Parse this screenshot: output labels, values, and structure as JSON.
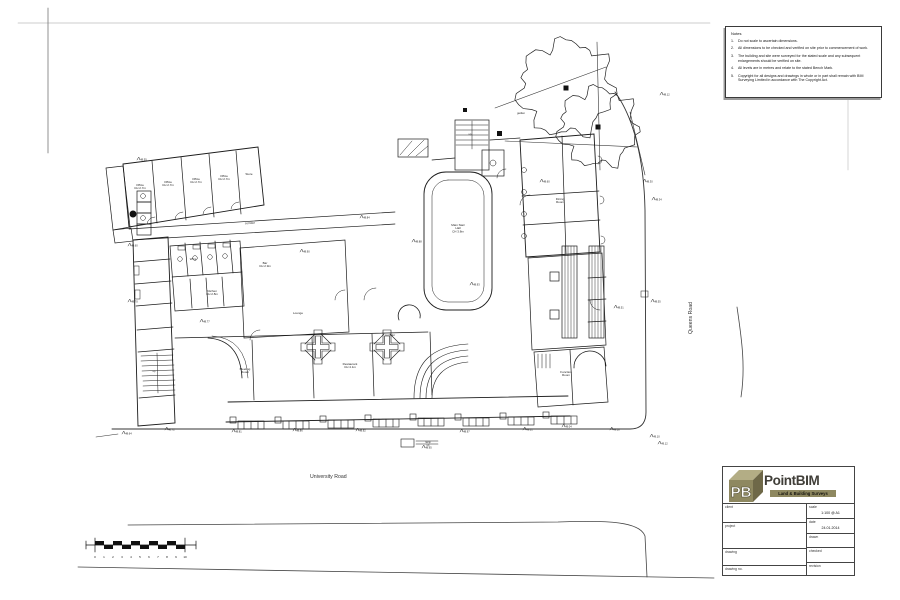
{
  "sheet": {
    "notes": {
      "title": "Notes",
      "items": [
        {
          "n": "1.",
          "text": "Do not scale to ascertain dimensions."
        },
        {
          "n": "2.",
          "text": "All dimensions to be checked and verified on site prior to commencement of work."
        },
        {
          "n": "3.",
          "text": "The building and site were surveyed for the stated scale and any subsequent enlargements should be verified on site."
        },
        {
          "n": "4.",
          "text": "All levels are in metres and relate to the stated Bench Mark."
        },
        {
          "n": "5.",
          "text": "Copyright for all designs and drawings in whole or in part shall remain with BIM Surveying Limited in accordance with The Copyright Act."
        }
      ]
    },
    "roads": {
      "university": "University Road",
      "queens": "Queens Road"
    },
    "scalebar": {
      "numbers": [
        "0",
        "1",
        "2",
        "3",
        "4",
        "5",
        "6",
        "7",
        "8",
        "9",
        "10"
      ]
    },
    "titleblock": {
      "brand": "PointBIM",
      "tagline": "Land & Building Surveys",
      "logo_letters": "PB",
      "fields": [
        {
          "label": "client",
          "value": ""
        },
        {
          "label": "project",
          "value": ""
        },
        {
          "label": "drawing",
          "value": ""
        },
        {
          "label": "drawing no.",
          "value": ""
        },
        {
          "label": "scale",
          "value": "1:100 @ A1"
        },
        {
          "label": "date",
          "value": "24.01.2014"
        },
        {
          "label": "drawn",
          "value": ""
        },
        {
          "label": "checked",
          "value": ""
        },
        {
          "label": "revision",
          "value": ""
        }
      ]
    },
    "colors": {
      "accent_olive": "#8e8860",
      "line": "#1c1c1c"
    }
  },
  "plan": {
    "room_labels": [
      {
        "x": 140,
        "y": 186,
        "lines": [
          "Office",
          "CH 2.7m"
        ]
      },
      {
        "x": 168,
        "y": 183,
        "lines": [
          "Office",
          "CH 2.7m"
        ]
      },
      {
        "x": 196,
        "y": 180,
        "lines": [
          "Office",
          "CH 2.7m"
        ]
      },
      {
        "x": 224,
        "y": 177,
        "lines": [
          "Office",
          "CH 2.7m"
        ]
      },
      {
        "x": 249,
        "y": 175,
        "lines": [
          "Store"
        ]
      },
      {
        "x": 193,
        "y": 260,
        "lines": [
          "WCs"
        ]
      },
      {
        "x": 212,
        "y": 292,
        "lines": [
          "Kitchen",
          "CH 2.8m"
        ]
      },
      {
        "x": 265,
        "y": 264,
        "lines": [
          "Bar",
          "CH 2.9m"
        ]
      },
      {
        "x": 298,
        "y": 314,
        "lines": [
          "Lounge"
        ]
      },
      {
        "x": 458,
        "y": 226,
        "lines": [
          "Main Stair",
          "Hall",
          "CH 3.8m"
        ]
      },
      {
        "x": 560,
        "y": 200,
        "lines": [
          "Dining",
          "Room"
        ]
      },
      {
        "x": 566,
        "y": 373,
        "lines": [
          "Function",
          "Room"
        ]
      },
      {
        "x": 245,
        "y": 370,
        "lines": [
          "Meeting",
          "Room"
        ]
      },
      {
        "x": 350,
        "y": 365,
        "lines": [
          "Restaurant",
          "CH 4.1m"
        ]
      },
      {
        "x": 250,
        "y": 224,
        "lines": [
          "corridor"
        ],
        "rot": -3
      },
      {
        "x": 390,
        "y": 336,
        "lines": [
          "corridor"
        ]
      },
      {
        "x": 154,
        "y": 372,
        "lines": [
          "up"
        ],
        "fs": 2.5
      },
      {
        "x": 470,
        "y": 135,
        "lines": [
          "up"
        ],
        "fs": 2.5
      },
      {
        "x": 521,
        "y": 114,
        "lines": [
          "garden"
        ],
        "fs": 2.6
      },
      {
        "x": 428,
        "y": 443,
        "lines": [
          "ramp",
          "up"
        ],
        "fs": 2.4
      }
    ],
    "spot_levels": [
      {
        "x": 122,
        "y": 434,
        "v": "48.64"
      },
      {
        "x": 165,
        "y": 430,
        "v": "48.72"
      },
      {
        "x": 232,
        "y": 432,
        "v": "48.81"
      },
      {
        "x": 293,
        "y": 431,
        "v": "48.86"
      },
      {
        "x": 356,
        "y": 431,
        "v": "48.92"
      },
      {
        "x": 422,
        "y": 448,
        "v": "48.95"
      },
      {
        "x": 460,
        "y": 432,
        "v": "48.97"
      },
      {
        "x": 523,
        "y": 430,
        "v": "49.01"
      },
      {
        "x": 562,
        "y": 427,
        "v": "49.04"
      },
      {
        "x": 610,
        "y": 430,
        "v": "49.08"
      },
      {
        "x": 650,
        "y": 437,
        "v": "49.10"
      },
      {
        "x": 658,
        "y": 444,
        "v": "49.12"
      },
      {
        "x": 651,
        "y": 302,
        "v": "48.55"
      },
      {
        "x": 614,
        "y": 308,
        "v": "48.51"
      },
      {
        "x": 652,
        "y": 200,
        "v": "48.34"
      },
      {
        "x": 643,
        "y": 182,
        "v": "48.30"
      },
      {
        "x": 660,
        "y": 95,
        "v": "48.12"
      },
      {
        "x": 300,
        "y": 252,
        "v": "48.90"
      },
      {
        "x": 412,
        "y": 242,
        "v": "48.88"
      },
      {
        "x": 200,
        "y": 322,
        "v": "48.77"
      },
      {
        "x": 128,
        "y": 302,
        "v": "48.70"
      },
      {
        "x": 470,
        "y": 285,
        "v": "48.93"
      },
      {
        "x": 540,
        "y": 182,
        "v": "48.60"
      },
      {
        "x": 360,
        "y": 218,
        "v": "48.84"
      },
      {
        "x": 137,
        "y": 160,
        "v": "48.55"
      },
      {
        "x": 128,
        "y": 246,
        "v": "48.60"
      }
    ],
    "trees": [
      {
        "cx": 566,
        "cy": 88,
        "r": 46
      },
      {
        "cx": 598,
        "cy": 127,
        "r": 38
      }
    ]
  }
}
